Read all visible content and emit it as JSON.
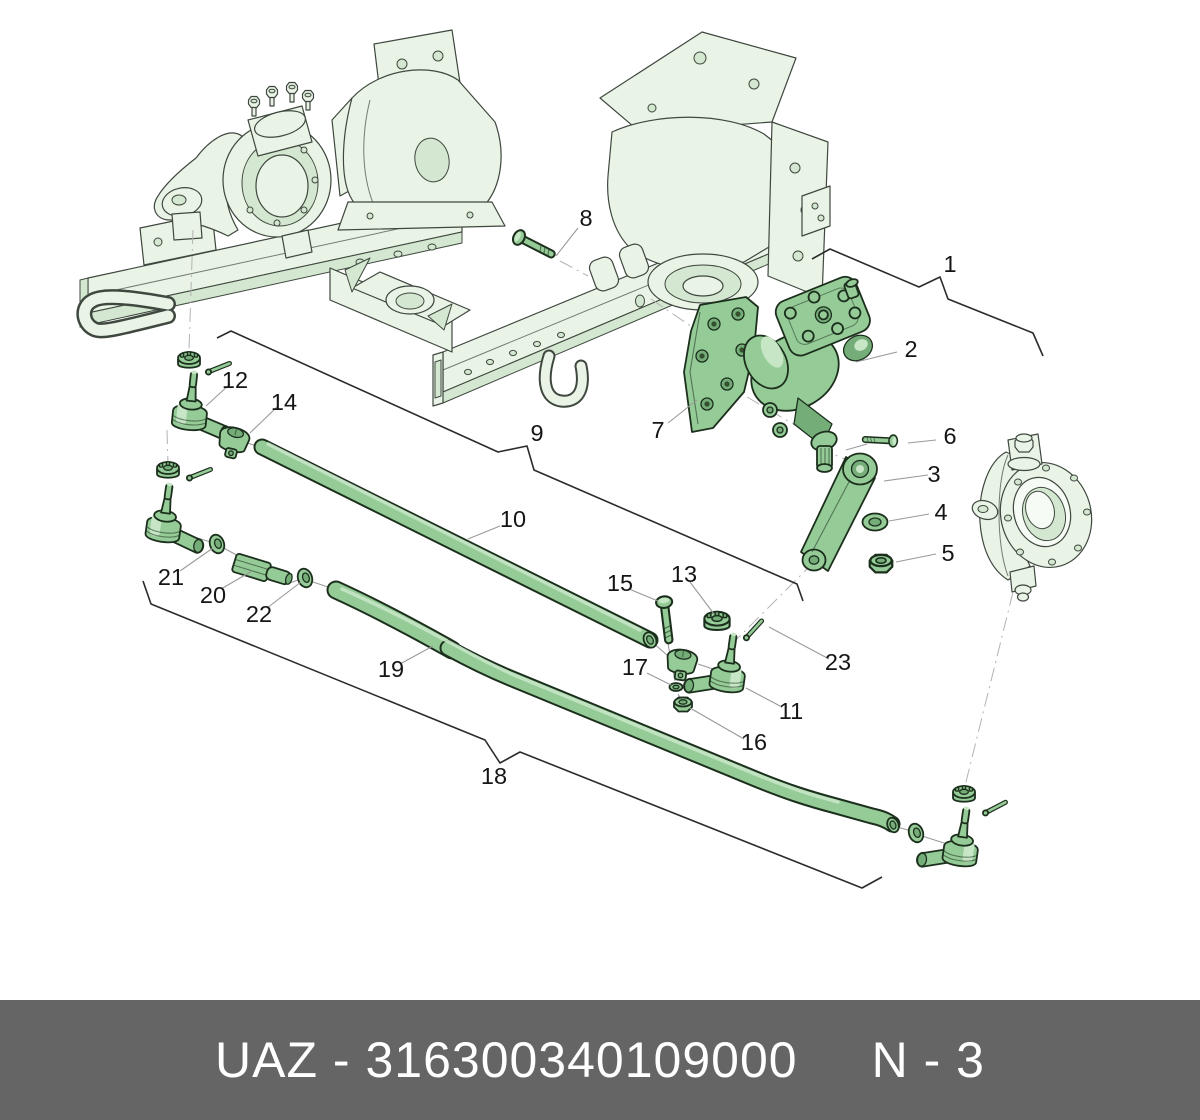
{
  "footer": {
    "brand_code": "UAZ - 316300340109000",
    "sheet_number": "N - 3"
  },
  "labels": {
    "n1": "1",
    "n2": "2",
    "n3": "3",
    "n4": "4",
    "n5": "5",
    "n6": "6",
    "n7": "7",
    "n8": "8",
    "n9": "9",
    "n10": "10",
    "n11": "11",
    "n12": "12",
    "n13": "13",
    "n14": "14",
    "n15": "15",
    "n16": "16",
    "n17": "17",
    "n18": "18",
    "n19": "19",
    "n20": "20",
    "n21": "21",
    "n22": "22",
    "n23": "23"
  },
  "colors": {
    "part_fill": "#95cb97",
    "part_dark": "#74ad78",
    "part_light": "#c6e6c6",
    "outline": "#1c2f1d",
    "frame_fill": "#e9f3e6",
    "frame_shade": "#d4e7d0",
    "frame_outline": "#3f483f",
    "leader": "#9a9a9a",
    "bracket": "#2b2b2b",
    "footer_bg": "#656565",
    "footer_text": "#ffffff",
    "hole_dark": "#33502f"
  }
}
